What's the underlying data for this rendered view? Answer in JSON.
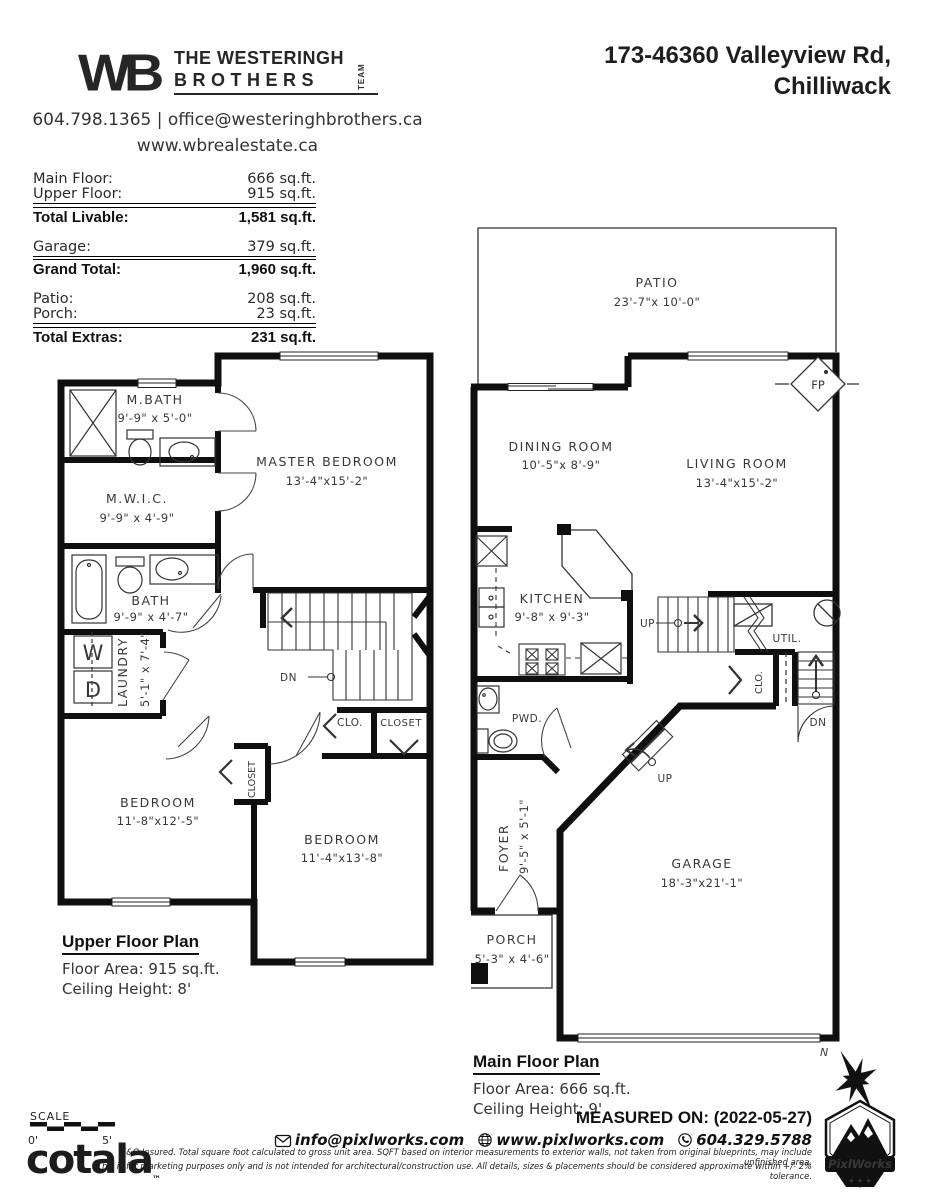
{
  "colors": {
    "wall": "#0f0f0f",
    "ink": "#383838",
    "background": "#ffffff"
  },
  "header": {
    "logo_mark": "WB",
    "brand_line1": "THE WESTERINGH",
    "brand_line2": "BROTHERS",
    "brand_team": "TEAM",
    "address_line1": "173-46360 Valleyview Rd,",
    "address_line2": "Chilliwack",
    "contact": "604.798.1365 | office@westeringhbrothers.ca",
    "website": "www.wbrealestate.ca"
  },
  "area_table": {
    "groups": [
      {
        "rows": [
          {
            "label": "Main Floor:",
            "value": "666 sq.ft."
          },
          {
            "label": "Upper Floor:",
            "value": "915 sq.ft."
          }
        ],
        "total": {
          "label": "Total Livable:",
          "value": "1,581 sq.ft."
        }
      },
      {
        "rows": [
          {
            "label": "Garage:",
            "value": "379 sq.ft."
          }
        ],
        "total": {
          "label": "Grand Total:",
          "value": "1,960 sq.ft."
        }
      },
      {
        "rows": [
          {
            "label": "Patio:",
            "value": "208 sq.ft."
          },
          {
            "label": "Porch:",
            "value": "23 sq.ft."
          }
        ],
        "total": {
          "label": "Total Extras:",
          "value": "231 sq.ft."
        }
      }
    ]
  },
  "upper_plan": {
    "title": "Upper Floor Plan",
    "floor_area": "Floor Area: 915 sq.ft.",
    "ceiling_height": "Ceiling Height: 8'",
    "rooms": {
      "mbath": {
        "name": "M.BATH",
        "dims": "9'-9\" x 5'-0\""
      },
      "master": {
        "name": "MASTER BEDROOM",
        "dims": "13'-4\"x15'-2\""
      },
      "mwic": {
        "name": "M.W.I.C.",
        "dims": "9'-9\" x 4'-9\""
      },
      "bath": {
        "name": "BATH",
        "dims": "9'-9\" x 4'-7\""
      },
      "laundry": {
        "name": "LAUNDRY",
        "dims": "5'-1\" x 7'-4\""
      },
      "bedroom_left": {
        "name": "BEDROOM",
        "dims": "11'-8\"x12'-5\""
      },
      "bedroom_right": {
        "name": "BEDROOM",
        "dims": "11'-4\"x13'-8\""
      }
    },
    "labels": {
      "dn": "DN",
      "clo": "CLO.",
      "closet": "CLOSET",
      "closet_small": "CLOSET",
      "washer": "W",
      "dryer": "D"
    }
  },
  "main_plan": {
    "title": "Main Floor Plan",
    "floor_area": "Floor Area: 666 sq.ft.",
    "ceiling_height": "Ceiling Height: 9'",
    "rooms": {
      "patio": {
        "name": "PATIO",
        "dims": "23'-7\"x 10'-0\""
      },
      "dining": {
        "name": "DINING ROOM",
        "dims": "10'-5\"x  8'-9\""
      },
      "living": {
        "name": "LIVING ROOM",
        "dims": "13'-4\"x15'-2\""
      },
      "kitchen": {
        "name": "KITCHEN",
        "dims": "9'-8\" x 9'-3\""
      },
      "garage": {
        "name": "GARAGE",
        "dims": "18'-3\"x21'-1\""
      },
      "foyer": {
        "name": "FOYER",
        "dims": "9'-5\" x 5'-1\""
      },
      "porch": {
        "name": "PORCH",
        "dims": "5'-3\" x  4'-6\""
      }
    },
    "labels": {
      "pwd": "PWD.",
      "util": "UTIL.",
      "clo": "CLO.",
      "fireplace": "FP",
      "up_stairs": "UP",
      "up_entry": "UP",
      "dn": "DN"
    }
  },
  "footer": {
    "measured_on": "MEASURED ON: (2022-05-27)",
    "email": "info@pixlworks.com",
    "website": "www.pixlworks.com",
    "phone": "604.329.5788",
    "disclaimer_line1": "E&O Insured.  Total square foot calculated to gross unit area. SQFT based on interior measurements to exterior walls, not taken from original blueprints, may include unfinished area.",
    "disclaimer_line2": "This is for marketing purposes only and is not intended for architectural/construction use.  All details, sizes & placements should be considered approximate within +/- 2%  tolerance.",
    "cotala": "cotala",
    "cotala_tm": "™",
    "scale_label": "SCALE",
    "scale_start": "0'",
    "scale_end": "5'",
    "badge": "PixlWorks",
    "compass_n": "N"
  }
}
